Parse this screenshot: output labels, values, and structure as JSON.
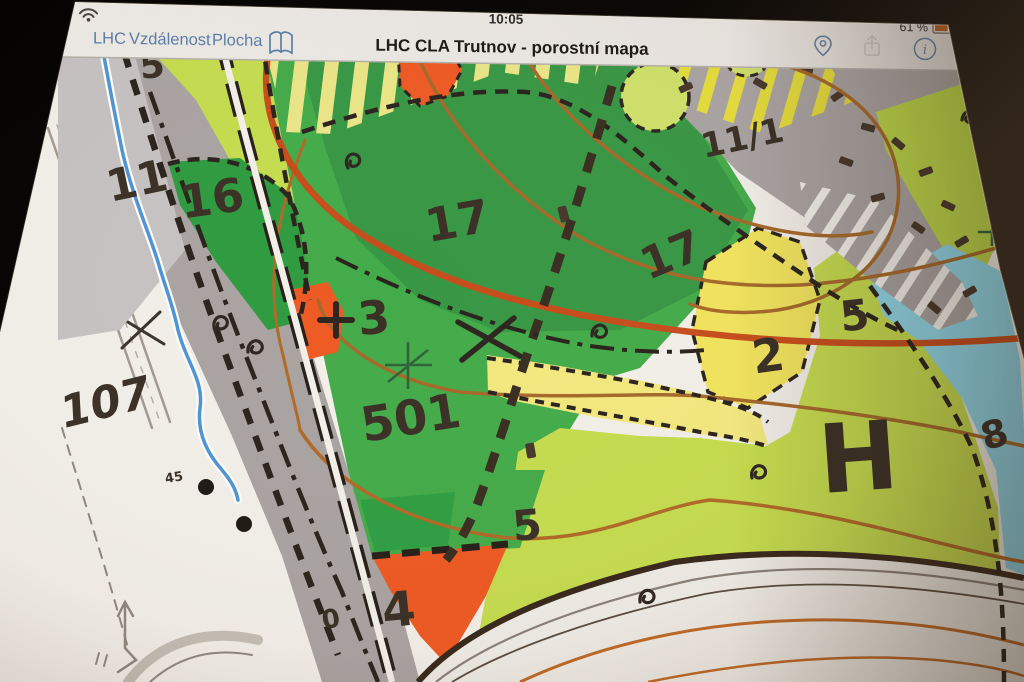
{
  "status_bar": {
    "time": "10:05",
    "battery": "61 %",
    "wifi_icon": "wifi"
  },
  "nav_bar": {
    "buttons": [
      {
        "label": "LHC"
      },
      {
        "label": "Vzdálenost"
      },
      {
        "label": "Plocha"
      }
    ],
    "book_icon": "bookmarks",
    "title": "LHC CLA Trutnov - porostní mapa",
    "right_icons": [
      {
        "name": "location-pin"
      },
      {
        "name": "share",
        "disabled": true
      },
      {
        "name": "info"
      }
    ],
    "info_glyph": "i"
  },
  "map": {
    "type": "forest-stand-map",
    "labels": [
      {
        "text": "5"
      },
      {
        "text": "11"
      },
      {
        "text": "16"
      },
      {
        "text": "17"
      },
      {
        "text": "17"
      },
      {
        "text": "11/1"
      },
      {
        "text": "3"
      },
      {
        "text": "501"
      },
      {
        "text": "107"
      },
      {
        "text": "2"
      },
      {
        "text": "5"
      },
      {
        "text": "8"
      },
      {
        "text": "5"
      },
      {
        "text": "4"
      },
      {
        "text": "H"
      },
      {
        "text": "45"
      },
      {
        "text": "0"
      }
    ],
    "colors": {
      "forest_green": "#44ab4a",
      "dark_green": "#379544",
      "young_green": "#c5dc4f",
      "meadow_yellow": "#f1e45e",
      "pale_yellow": "#f3e87f",
      "water_cyan": "#8fd8ea",
      "clearing_orange": "#ee5a24",
      "road_gray": "#a9a3a2",
      "contour_brown": "#a5692b",
      "contour_thick_red": "#c74e1d",
      "accent_blue": "#5b7ea8"
    }
  }
}
